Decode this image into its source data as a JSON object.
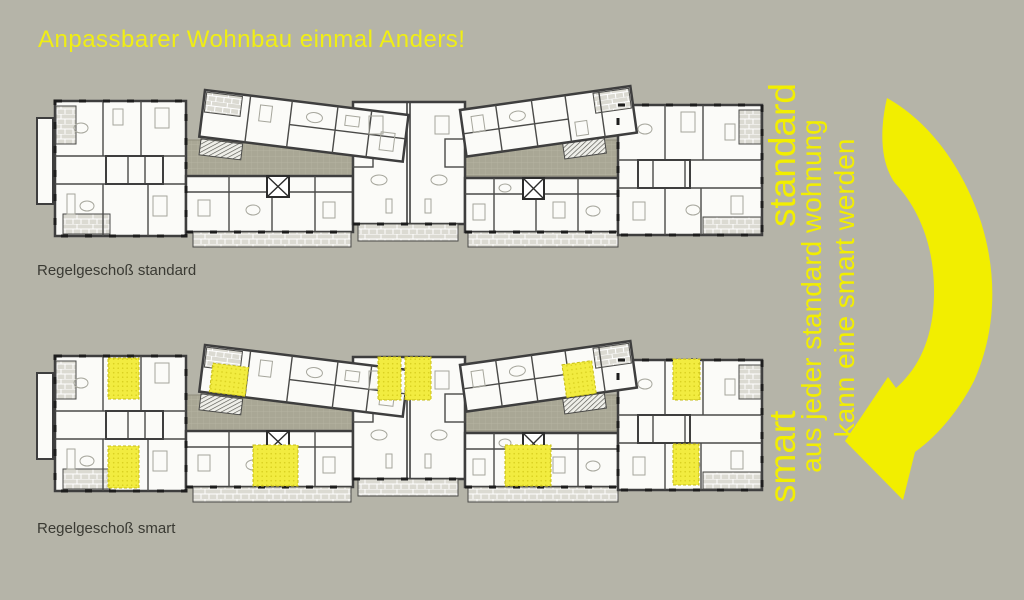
{
  "slide": {
    "title": "Anpassbarer Wohnbau einmal Anders!",
    "background_color": "#b5b4a8",
    "accent_yellow": "#f2ee00",
    "highlight_room_yellow": "#f2ec40"
  },
  "plans": [
    {
      "id": "standard",
      "label": "Regelgeschoß standard",
      "highlighted_rooms": false
    },
    {
      "id": "smart",
      "label": "Regelgeschoß smart",
      "highlighted_rooms": true
    }
  ],
  "annotation": {
    "standard_label": "standard",
    "smart_label": "smart",
    "line2": "aus jeder standard wohnung",
    "line3": "kann eine smart werden",
    "arrow_icon": "curved-arrow-down-left",
    "color": "#f2ee00"
  }
}
